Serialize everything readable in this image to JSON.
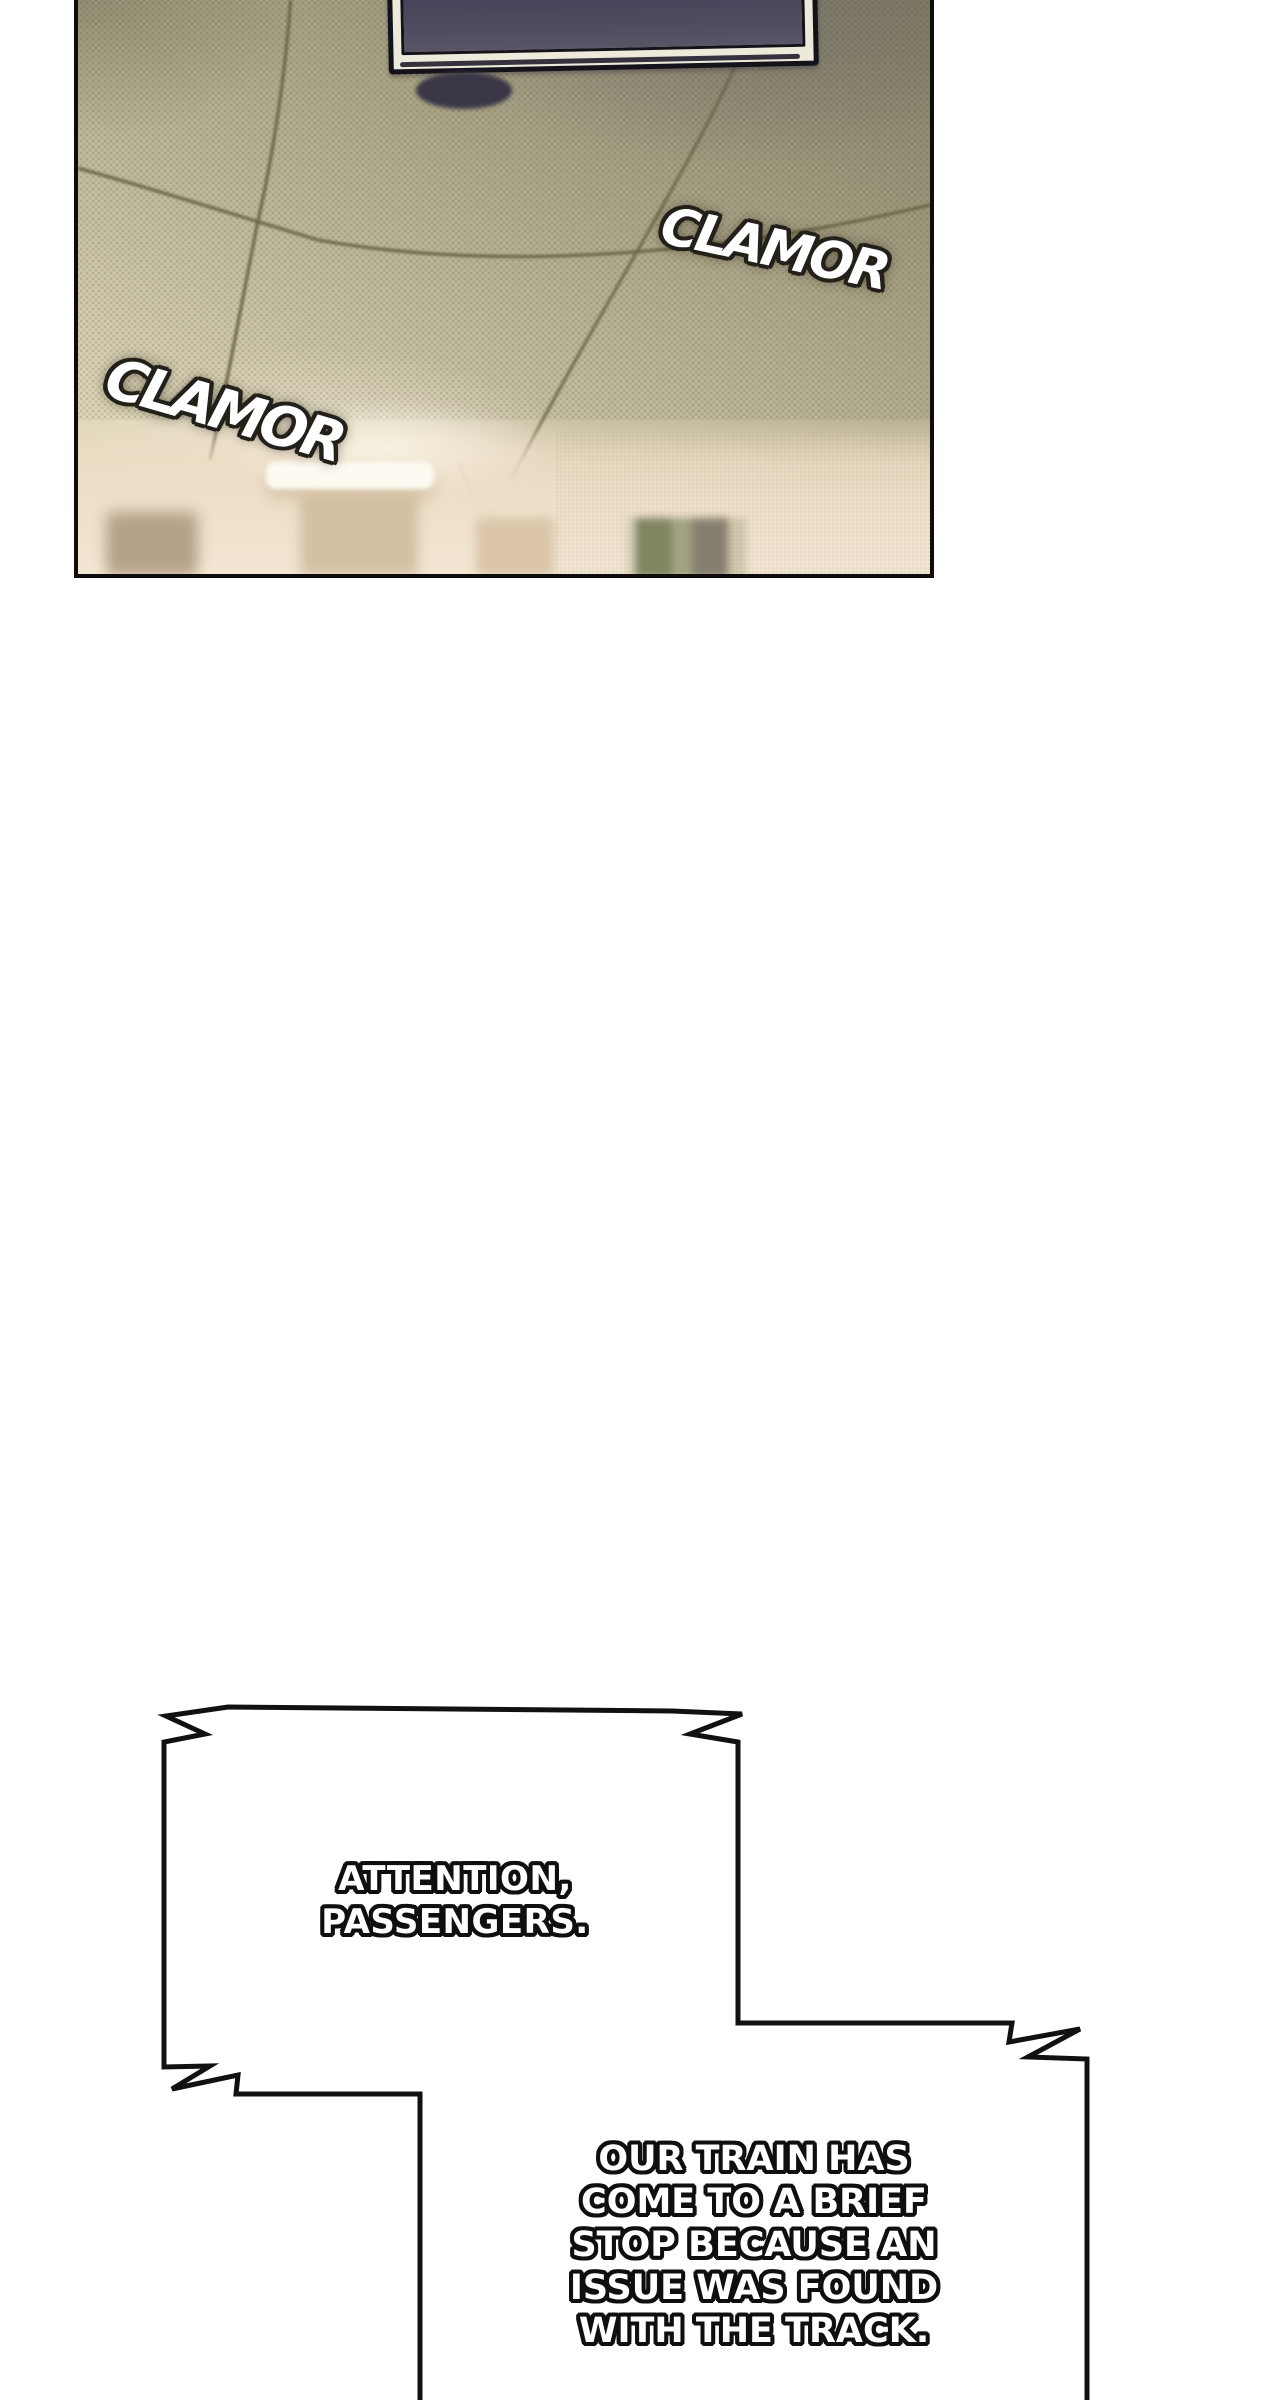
{
  "page": {
    "type": "webtoon-comic-page",
    "background_color": "#ffffff",
    "outline_color": "#111111"
  },
  "panel": {
    "scene_description": "Blurry photographic view of a train car ceiling with a hanging monitor, speaker, ceiling seams and a light wall with a fluorescent lamp below",
    "sfx": [
      {
        "text": "CLAMOR",
        "position": "upper-right"
      },
      {
        "text": "CLAMOR",
        "position": "mid-left"
      }
    ],
    "colors": {
      "ceiling_dark": "#837e66",
      "ceiling_light": "#e9e0c5",
      "wall": "#f0e3cd",
      "tv_screen": "#4f4a5c",
      "tv_frame": "#edeadc",
      "speaker": "#3a3646",
      "seam_line": "#6b6548",
      "window_green": "#7f8461",
      "sfx_fill": "#ffffff",
      "sfx_outline": "#23201a"
    }
  },
  "bubble": {
    "style": "angular-announcement-lightning-corners",
    "fill": "#ffffff",
    "stroke": "#111111",
    "attention_lines": [
      "ATTENTION,",
      "PASSENGERS."
    ],
    "announcement_lines": [
      "OUR TRAIN HAS",
      "COME TO A BRIEF",
      "STOP BECAUSE AN",
      "ISSUE WAS FOUND",
      "WITH THE TRACK."
    ]
  }
}
